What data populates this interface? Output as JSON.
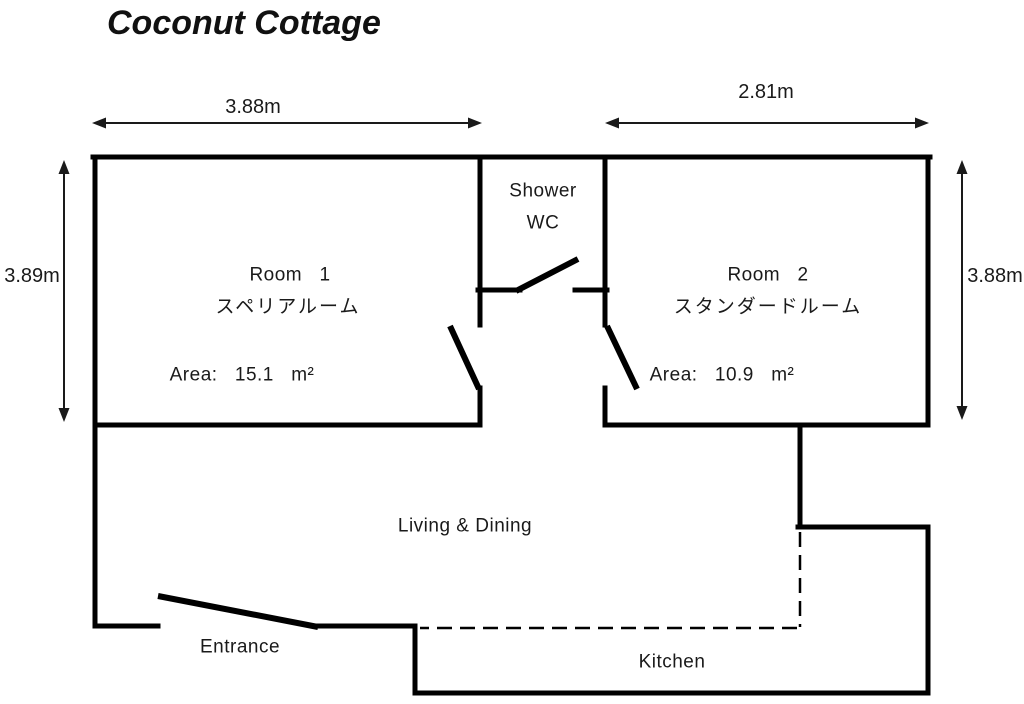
{
  "title": "Coconut Cottage",
  "dimensions": {
    "top_left_width": "3.88m",
    "top_right_width": "2.81m",
    "left_height": "3.89m",
    "right_height": "3.88m"
  },
  "rooms": {
    "room1": {
      "name": "Room   1",
      "name_jp": "スペリアルーム",
      "area": "Area:   15.1   m²"
    },
    "room2": {
      "name": "Room   2",
      "name_jp": "スタンダードルーム",
      "area": "Area:   10.9   m²"
    },
    "shower": {
      "line1": "Shower",
      "line2": "WC"
    },
    "living": {
      "label": "Living & Dining"
    },
    "entrance": {
      "label": "Entrance"
    },
    "kitchen": {
      "label": "Kitchen"
    }
  },
  "colors": {
    "wall": "#000000",
    "text": "#1a1a1a",
    "background": "#ffffff"
  }
}
